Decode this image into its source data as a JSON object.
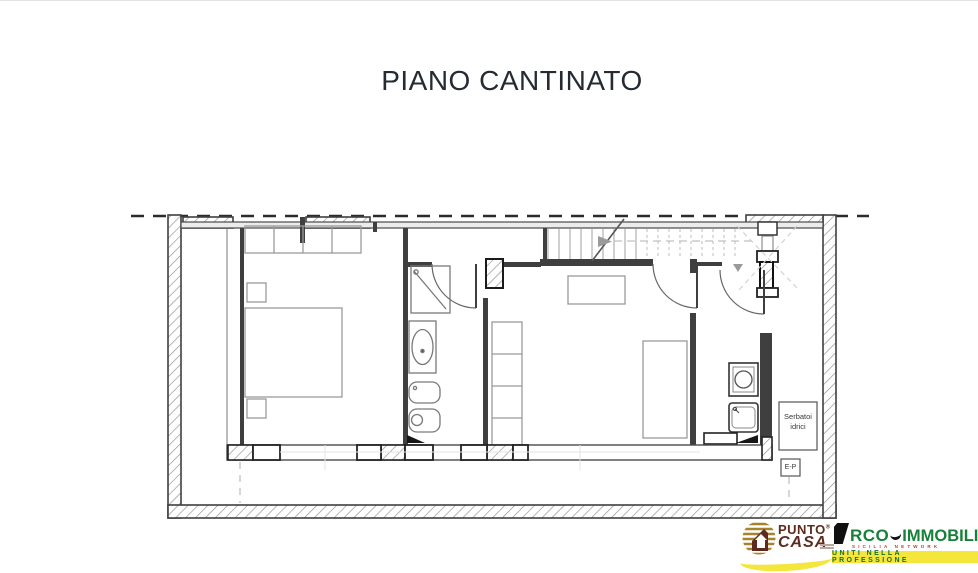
{
  "title": "PIANO CANTINATO",
  "plan": {
    "water_tanks_label": "Serbatoi idrici",
    "electrical_panel_label": "E-P"
  },
  "footer": {
    "punto_casa": {
      "punto": "PUNTO",
      "registered": "®",
      "casa": "CASA"
    },
    "arco": {
      "rco": "RCO",
      "immobiliare": "IMMOBILIARE",
      "network": "SICILIA NETWORK",
      "tagline": "UNITI NELLA PROFESSIONE"
    }
  },
  "colors": {
    "title": "#262b33",
    "walls": "#3f3f3f",
    "furniture": "#9a9a9a",
    "punto_casa_text": "#5c2b1d",
    "punto_casa_gold": "#a5832f",
    "punto_casa_yellow": "#f4e63a",
    "arco_green": "#17813a",
    "arco_red": "#c0392b",
    "band_yellow": "#f4e63a",
    "band_text_green": "#15702e"
  }
}
